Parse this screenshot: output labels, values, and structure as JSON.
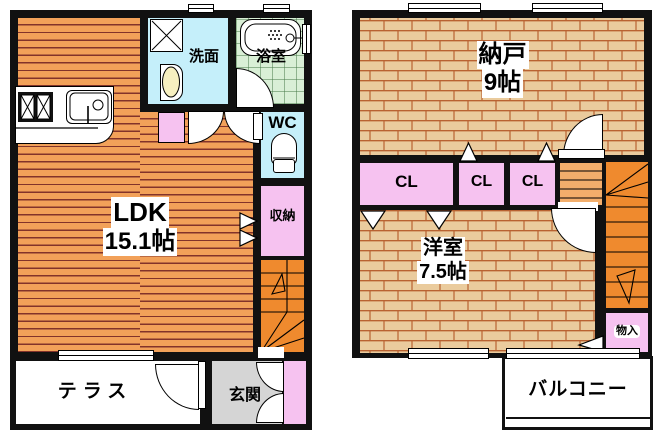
{
  "floor1": {
    "ldk": {
      "name": "LDK",
      "size": "15.1帖"
    },
    "washroom": {
      "name": "洗面"
    },
    "bathroom": {
      "name": "浴室"
    },
    "toilet": {
      "name": "WC"
    },
    "closet": {
      "name": "収納"
    },
    "terrace": {
      "name": "テラス"
    },
    "entrance": {
      "name": "玄関"
    }
  },
  "floor2": {
    "storeroom": {
      "name": "納戸",
      "size": "9帖"
    },
    "closets": [
      {
        "name": "CL"
      },
      {
        "name": "CL"
      },
      {
        "name": "CL"
      }
    ],
    "western_room": {
      "name": "洋室",
      "size": "7.5帖"
    },
    "storage": {
      "name": "物入"
    },
    "balcony": {
      "name": "バルコニー"
    }
  },
  "colors": {
    "wall": "#111111",
    "wood_floor": "#f2a159",
    "wood_stripe": "#82332a",
    "brick_floor": "#eacb9d",
    "brick_line": "#b96231",
    "stairs_orange": "#ef8a2e",
    "stairs_light": "#f3ae6b",
    "closet_pink": "#f6c2f0",
    "water_cyan": "#c5effa",
    "bath_green": "#d9efd6",
    "entrance_gray": "#d5d5d5"
  }
}
